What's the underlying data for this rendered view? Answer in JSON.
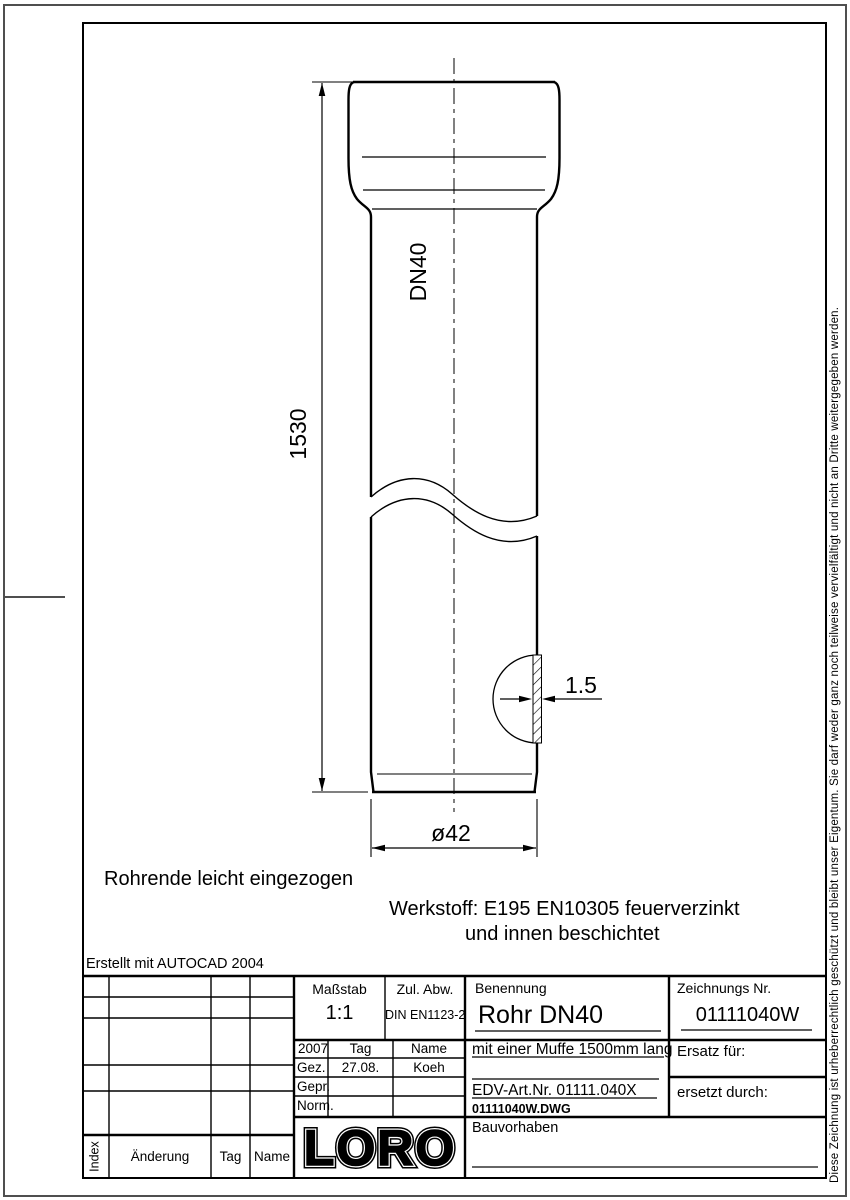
{
  "notes": {
    "pipe_end": "Rohrende leicht eingezogen",
    "material_line1": "Werkstoff: E195 EN10305 feuerverzinkt",
    "material_line2": "und innen beschichtet",
    "created_with": "Erstellt mit AUTOCAD 2004",
    "copyright": "Diese Zeichnung ist urheberrechtlich geschützt und bleibt unser Eigentum. Sie darf weder ganz noch teilweise vervielfältigt und nicht an Dritte weitergegeben werden."
  },
  "dimensions": {
    "length": "1530",
    "nominal": "DN40",
    "wall_thickness": "1.5",
    "diameter": "ø42"
  },
  "title_block": {
    "masstab_label": "Maßstab",
    "masstab_value": "1:1",
    "zul_abw_label": "Zul. Abw.",
    "zul_abw_value": "DIN EN1123-2",
    "benennung_label": "Benennung",
    "benennung_value": "Rohr DN40",
    "zeichnungs_nr_label": "Zeichnungs Nr.",
    "zeichnungs_nr_value": "01111040W",
    "year": "2007",
    "tag_label": "Tag",
    "name_label": "Name",
    "gez_label": "Gez.",
    "gez_tag": "27.08.",
    "gez_name": "Koeh",
    "gepr_label": "Gepr.",
    "norm_label": "Norm.",
    "subtitle": "mit einer Muffe 1500mm lang",
    "edv_art_nr": "EDV-Art.Nr. 01111.040X",
    "dwg_file": "01111040W.DWG",
    "ersatz_fuer_label": "Ersatz für:",
    "ersetzt_durch_label": "ersetzt durch:",
    "bauvorhaben_label": "Bauvorhaben",
    "logo": "LORO",
    "index_label": "Index",
    "aenderung_label": "Änderung",
    "tag2_label": "Tag",
    "name2_label": "Name"
  }
}
